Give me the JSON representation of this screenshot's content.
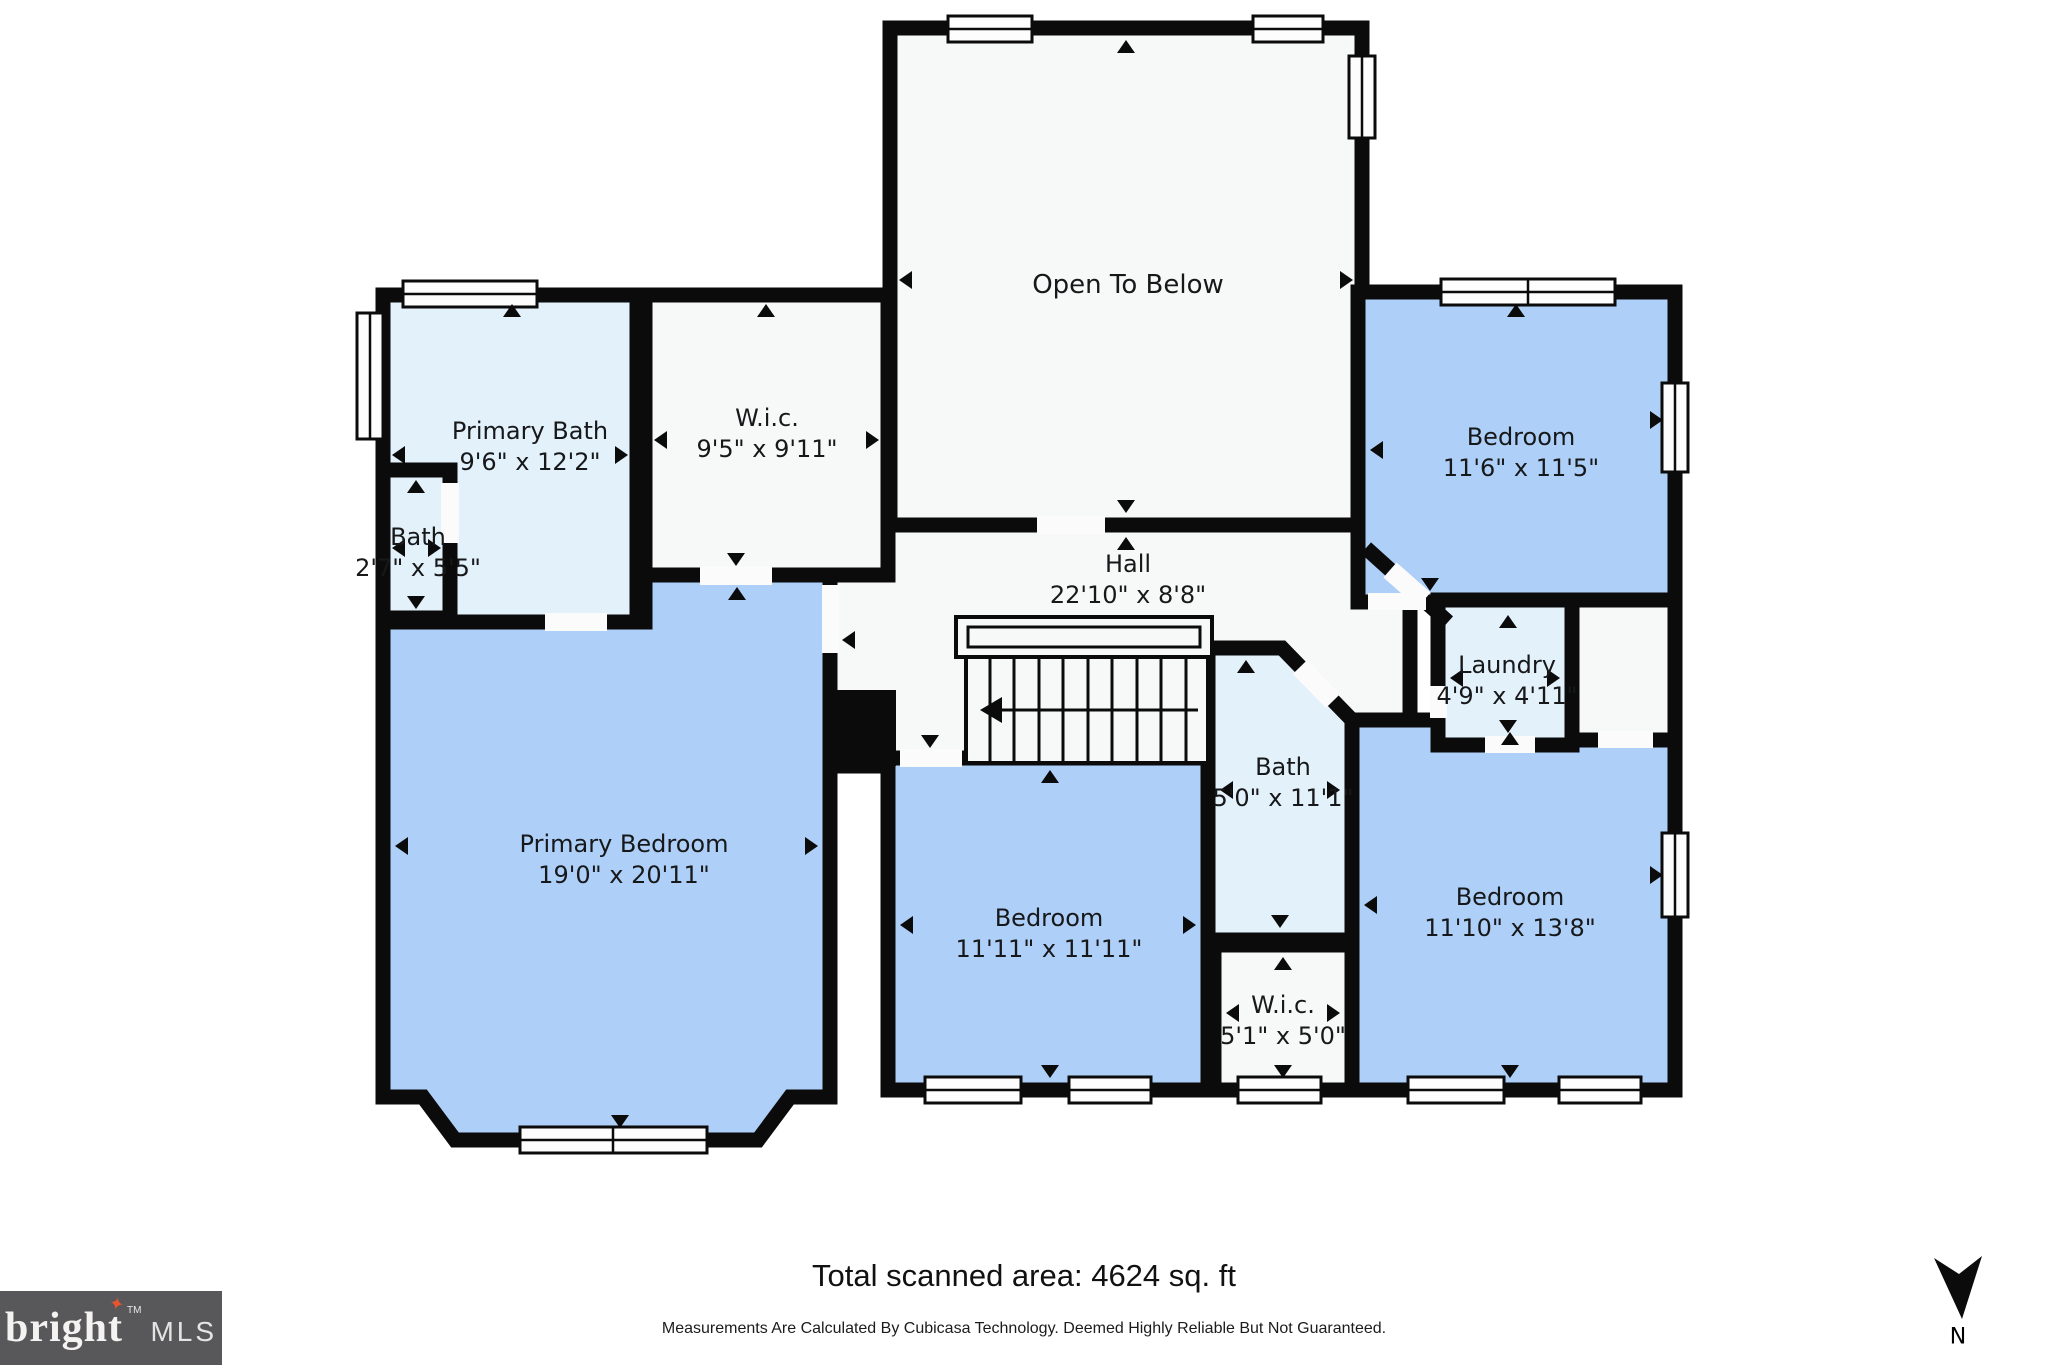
{
  "colors": {
    "wall": "#0b0b0b",
    "bedroom": "#aecff7",
    "bath": "#e3f1fb",
    "room_white": "#f7f8f8",
    "door_gap": "#fbfbfb",
    "logo_bg": "#58585a",
    "logo_star": "#e8542e",
    "logo_text": "#f4f3f1"
  },
  "rooms": {
    "open_below": {
      "name": "Open To Below",
      "dims": ""
    },
    "primary_bath": {
      "name": "Primary Bath",
      "dims": "9'6\" x 12'2\""
    },
    "wic_top": {
      "name": "W.i.c.",
      "dims": "9'5\" x 9'11\""
    },
    "bath_small": {
      "name": "Bath",
      "dims": "2'7\" x 5'5\""
    },
    "hall": {
      "name": "Hall",
      "dims": "22'10\" x 8'8\""
    },
    "bedroom_top_right": {
      "name": "Bedroom",
      "dims": "11'6\" x 11'5\""
    },
    "laundry": {
      "name": "Laundry",
      "dims": "4'9\" x 4'11\""
    },
    "bath_center": {
      "name": "Bath",
      "dims": "5'0\" x 11'1\""
    },
    "primary_bedroom": {
      "name": "Primary Bedroom",
      "dims": "19'0\" x 20'11\""
    },
    "bedroom_bottom_center": {
      "name": "Bedroom",
      "dims": "11'11\" x 11'11\""
    },
    "wic_bottom": {
      "name": "W.i.c.",
      "dims": "5'1\" x 5'0\""
    },
    "bedroom_bottom_right": {
      "name": "Bedroom",
      "dims": "11'10\" x 13'8\""
    }
  },
  "footer": {
    "total_area": "Total scanned area: 4624 sq. ft",
    "disclaimer": "Measurements Are Calculated By Cubicasa Technology. Deemed Highly Reliable But Not Guaranteed."
  },
  "branding": {
    "logo_primary": "bright",
    "logo_tm": "TM",
    "logo_secondary": "MLS",
    "logo_star_glyph": "✦"
  },
  "compass": {
    "label": "N"
  }
}
